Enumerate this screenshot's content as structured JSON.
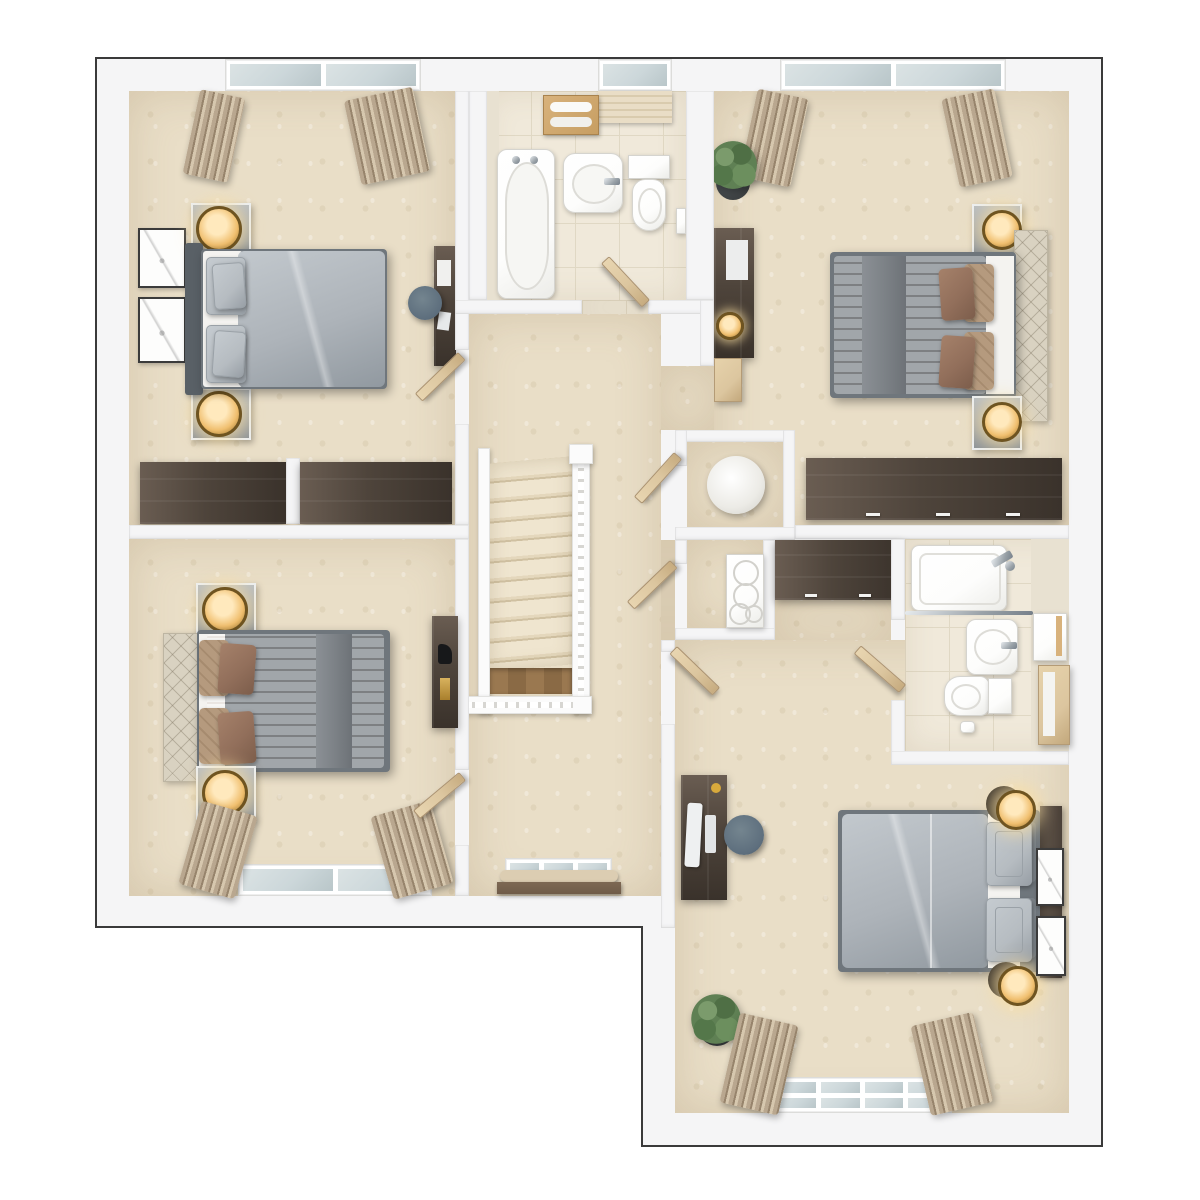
{
  "scene": {
    "type": "3d-top-down-floor-plan-render",
    "description": "Photoreal dollhouse-style first-floor plan: four bedrooms, family bathroom, en-suite shower room, central landing with staircase and two storage cupboards. No text labels are rendered in the image.",
    "footprint": "L-shaped",
    "background": "#ffffff"
  },
  "palette": {
    "canvas": "#ffffff",
    "wall": "#f5f5f6",
    "outline": "#3a3a3a",
    "carpet": "#e9dec7",
    "tile_floor": "#f0e9da",
    "tile_grout": "#e0d8c4",
    "tile_wall": "#e8e1d1",
    "wood_dark": "#4e443b",
    "wood_dark_hi": "#6a5d52",
    "wood_light": "#dcc69f",
    "wood_mid": "#8a6a45",
    "fixture": "#fdfdfc",
    "chrome": "#9aa2a8",
    "glass": "#ccd7da",
    "duvet_gray": "#adb3b9",
    "bed_frame": "#6f767c",
    "headboard_dark": "#596066",
    "duvet_pink": "#f1e5df",
    "runner": "#7d8287",
    "sheet": "#f4f3f0",
    "pillow_brown": "#926f5b",
    "pillow_tan": "#b59a7e",
    "pillow_gray": "#b6bcc1",
    "headboard_quilt": "#d9d2c1",
    "nightstand": "#8e9499",
    "lamp_gold": "#f0bf6f",
    "lamp_glow": "#ffe9bd",
    "stool": "#5d6e7d",
    "plant": "#5f8054",
    "pot": "#3e4244",
    "curtain": "#b9a78f",
    "curtain_dark": "#97846c",
    "radiator": "#6f5b49",
    "sill_fabric": "#dccdb2",
    "monitor": "#eef0f1"
  },
  "rooms": [
    {
      "id": "bedroom-top-left",
      "furniture": [
        "double-bed-gray-duvet",
        "dark-headboard",
        "4-gray-pillows",
        "2-nightstands",
        "2-gold-table-lamps",
        "2-wall-art-frames",
        "desk",
        "blue-stool",
        "built-in-wardrobe-2-sections",
        "double-window",
        "2-curtain-panels",
        "open-door"
      ]
    },
    {
      "id": "family-bathroom",
      "furniture": [
        "bathtub-with-taps",
        "pedestal-basin",
        "toilet",
        "window-with-blind",
        "towel-shelf",
        "towel-ring",
        "open-door"
      ]
    },
    {
      "id": "bedroom-top-right",
      "furniture": [
        "double-bed-pink-duvet-gray-runner",
        "quilted-headboard",
        "4-brown-tan-pillows",
        "2-nightstands",
        "2-gold-table-lamps",
        "desk-with-task-lamp",
        "side-table",
        "potted-plant",
        "built-in-wardrobe",
        "double-window",
        "2-curtain-panels",
        "open-door"
      ]
    },
    {
      "id": "landing",
      "furniture": [
        "staircase-13-steps",
        "white-balustrade",
        "newel-post",
        "lower-floor-wood-glimpse",
        "window",
        "radiator-shelf",
        "open-doors"
      ]
    },
    {
      "id": "cupboard-water-tank",
      "furniture": [
        "round-water-tank"
      ]
    },
    {
      "id": "cupboard-shelves",
      "furniture": [
        "white-shelf-unit-4-rings"
      ]
    },
    {
      "id": "bedroom-bottom-left",
      "furniture": [
        "double-bed-pink-duvet-gray-runner",
        "quilted-headboard",
        "brown-pillows",
        "2-nightstands",
        "2-gold-table-lamps",
        "tall-dark-dresser-with-task-lamp",
        "double-window",
        "2-curtain-panels",
        "open-door"
      ]
    },
    {
      "id": "bedroom-bottom-right",
      "furniture": [
        "double-bed-gray-duvet",
        "dark-wood-headboard",
        "2-gray-pillows",
        "2-gold-lamps-on-dark-stands",
        "2-wall-art-frames",
        "computer-desk-with-monitor-keyboard",
        "blue-stool",
        "potted-plant",
        "landing-wardrobe",
        "double-window",
        "2-curtain-panels",
        "open-door"
      ]
    },
    {
      "id": "en-suite",
      "furniture": [
        "shower-tray-with-chrome-valve",
        "glass-screen-rail",
        "wall-hung-basin",
        "toilet-with-cistern",
        "mirror-cabinet",
        "tall-cabinet",
        "toilet-roll"
      ]
    }
  ],
  "window_count": 6,
  "door_leaf_count": 7
}
